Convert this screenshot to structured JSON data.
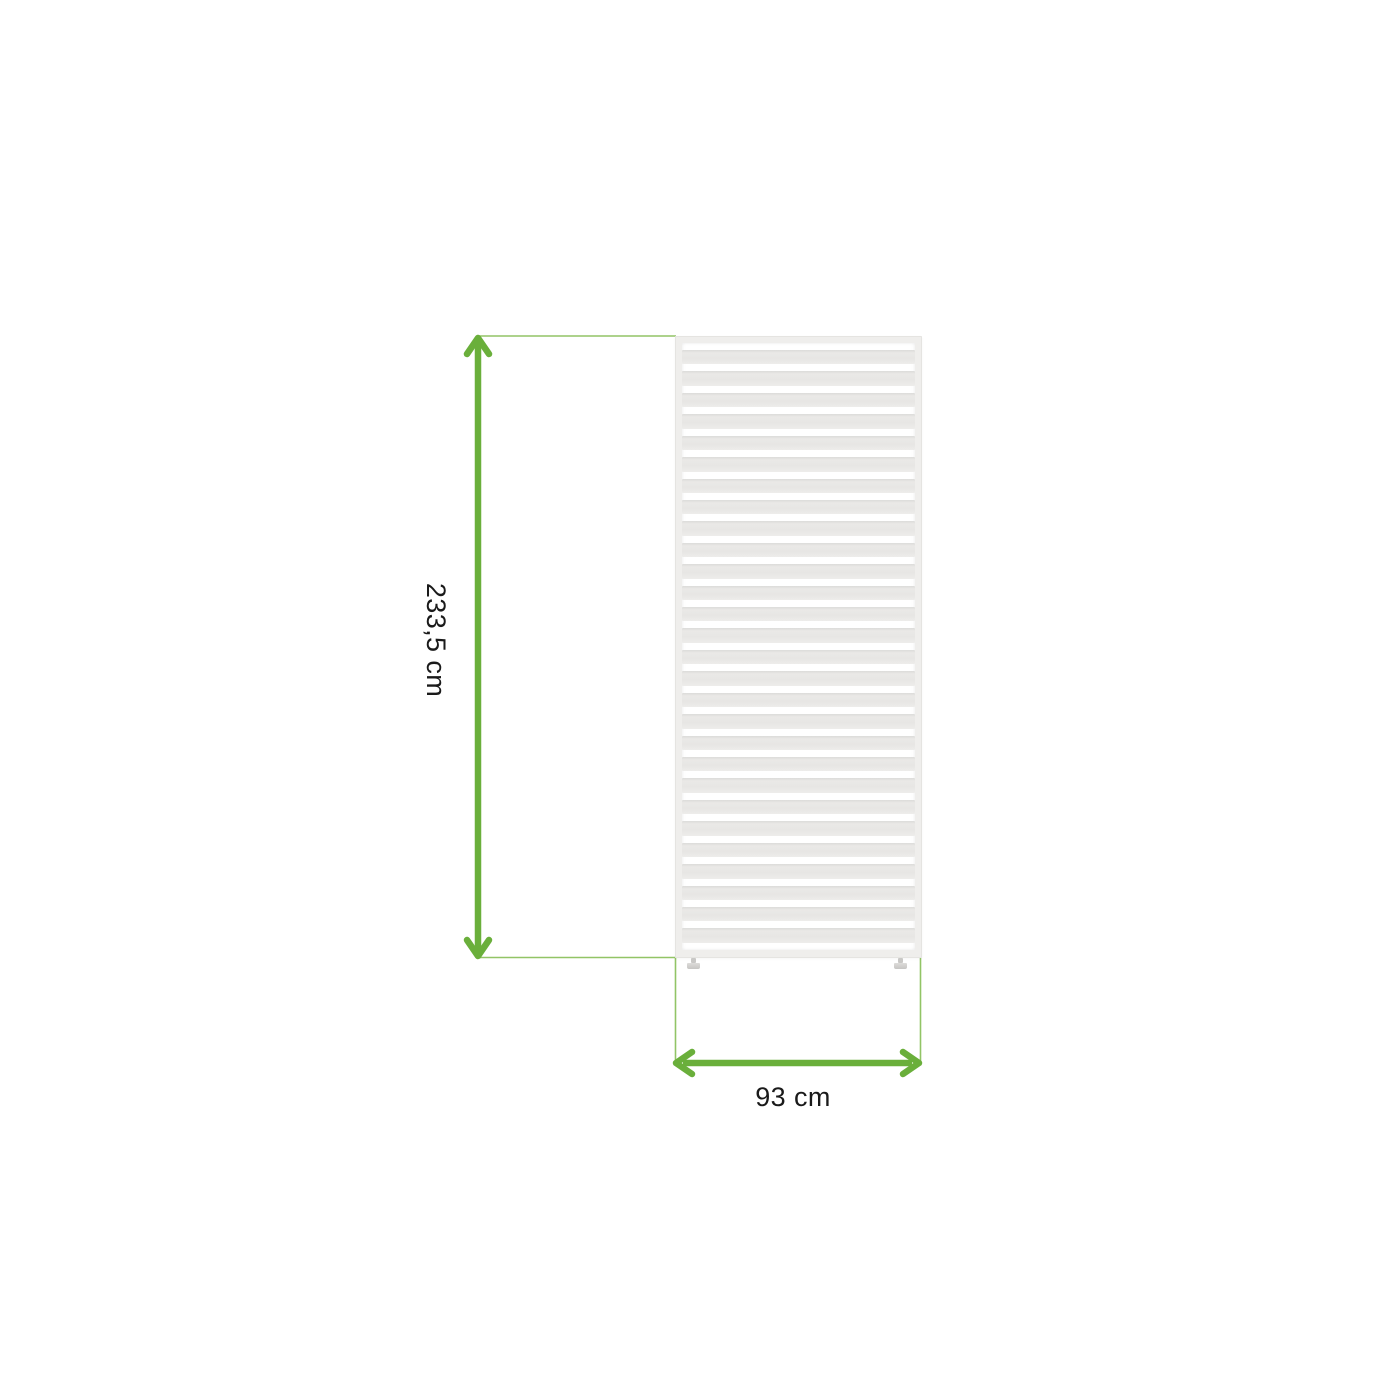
{
  "meta": {
    "description": "Product dimension diagram: white horizontal-slat privacy screen panel with two small leveling feet and green measurement arrows"
  },
  "dimensions": {
    "height": {
      "label": "233,5 cm"
    },
    "width": {
      "label": "93 cm"
    }
  },
  "panel": {
    "slat_count": 28,
    "slat_orientation": "horizontal",
    "feet_count": 2
  },
  "colors": {
    "background": "#ffffff",
    "arrow-green": "#6aaf3b",
    "extension-green": "#92c466",
    "panel-frame": "#efeeec",
    "panel-frame-edge": "#e5e4e1",
    "slat-gray": "#e8e7e5",
    "slat-shadow": "#dcdbd9",
    "gap-white": "#ffffff",
    "label-text": "#1a1a1a",
    "foot-gray": "#c9c8c6"
  }
}
